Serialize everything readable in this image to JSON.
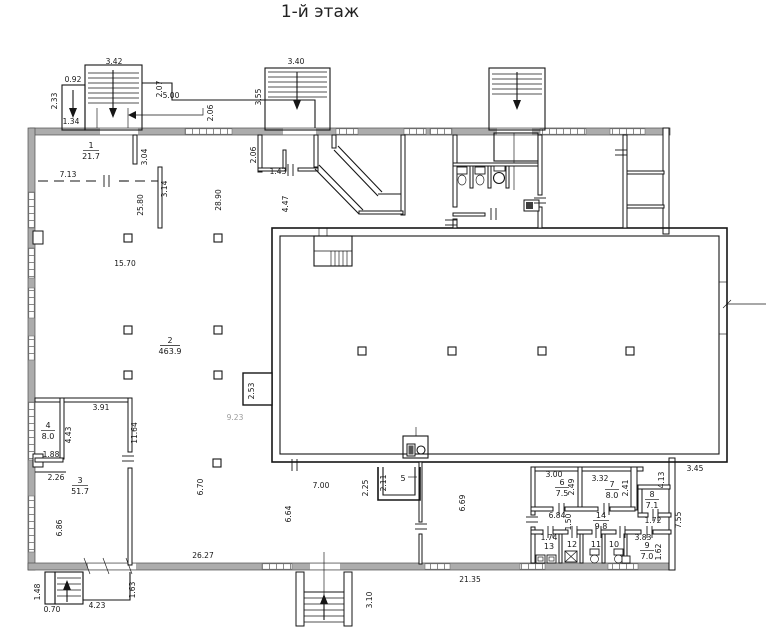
{
  "title": "1-й этаж",
  "colors": {
    "wall_gray": "#acacac",
    "line": "#161616",
    "muted_text": "#9a9a9a"
  },
  "rooms": [
    {
      "num": "1",
      "area": "21.7"
    },
    {
      "num": "2",
      "area": "463.9"
    },
    {
      "num": "3",
      "area": "51.7"
    },
    {
      "num": "4",
      "area": "8.0"
    },
    {
      "num": "5",
      "area": ""
    },
    {
      "num": "6",
      "area": "7.5"
    },
    {
      "num": "7",
      "area": "8.0"
    },
    {
      "num": "8",
      "area": "7.1"
    },
    {
      "num": "9",
      "area": "7.0"
    },
    {
      "num": "10",
      "area": ""
    },
    {
      "num": "11",
      "area": ""
    },
    {
      "num": "12",
      "area": ""
    },
    {
      "num": "13",
      "area": ""
    },
    {
      "num": "14",
      "area": "9.8"
    }
  ],
  "dims": {
    "a092": "0.92",
    "a233": "2.33",
    "a134": "1.34",
    "a342": "3.42",
    "a207": "2.07",
    "a500": "5.00",
    "a206": "2.06",
    "b340": "3.40",
    "b355": "3.55",
    "b206": "2.06",
    "b143": "1.43",
    "c304": "3.04",
    "c314": "3.14",
    "c713": "7.13",
    "h2580": "25.80",
    "h2890": "28.90",
    "h1570": "15.70",
    "h447": "4.47",
    "h253": "2.53",
    "h923": "9.23",
    "l391": "3.91",
    "l443": "4.43",
    "l188": "1.88",
    "l226": "2.26",
    "l1164": "11.64",
    "l686": "6.86",
    "m670": "6.70",
    "m700": "7.00",
    "m664": "6.64",
    "m225": "2.25",
    "m211": "2.11",
    "m669": "6.69",
    "f2627": "26.27",
    "f2135": "21.35",
    "f310": "3.10",
    "f148": "1.48",
    "f070": "0.70",
    "f423": "4.23",
    "f163": "1.63",
    "r300": "3.00",
    "r249": "2.49",
    "r332": "3.32",
    "r241": "2.41",
    "r413": "4.13",
    "r172": "1.72",
    "r684": "6.84",
    "r150": "1.50",
    "r174": "1.74",
    "r383": "3.83",
    "r162": "1.62",
    "r345": "3.45",
    "r755": "7.55"
  }
}
